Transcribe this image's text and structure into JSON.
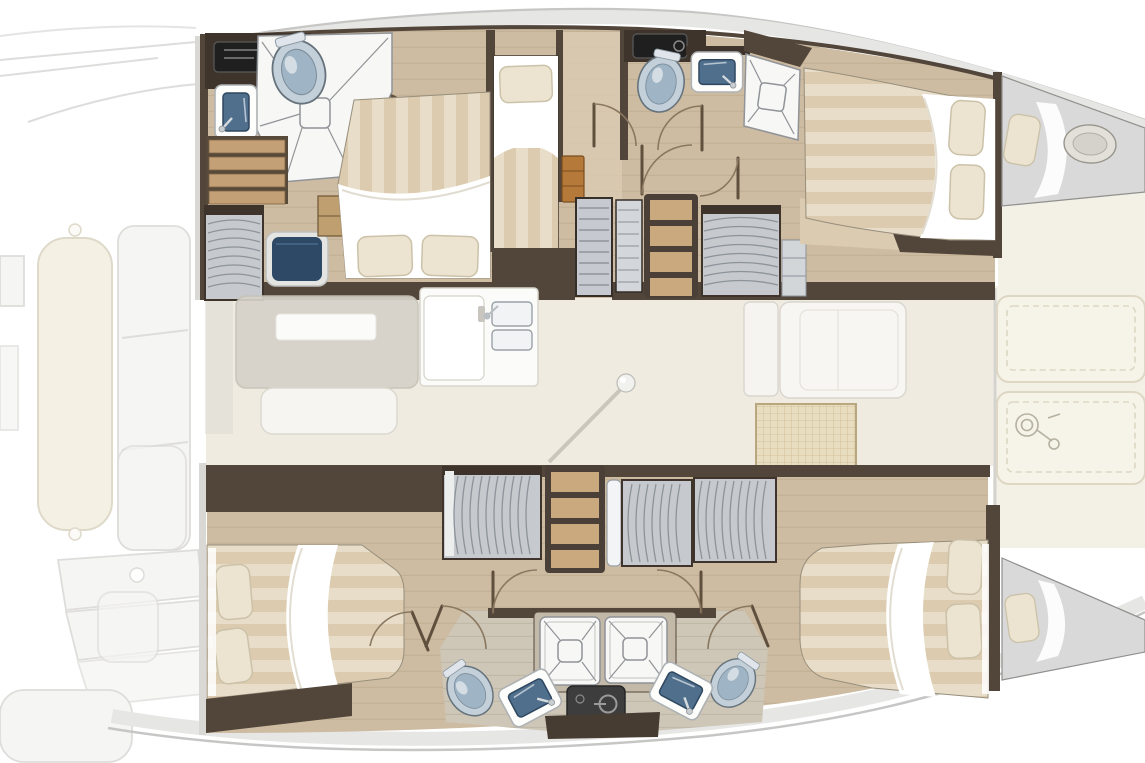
{
  "meta": {
    "type": "yacht-floorplan",
    "vessel": "catamaran",
    "view": "overhead interior deck plan, bows pointing right, no text labels in image"
  },
  "plan": {
    "hulls": [
      {
        "name": "upper hull",
        "rooms": [
          "aft bathroom with shower, toilet and washbasin",
          "aft double cabin with desk chair and wardrobe",
          "midship single berth",
          "midship bathroom with shower, toilet and washbasin",
          "forward double cabin",
          "forepeak crew berth"
        ]
      },
      {
        "name": "lower hull",
        "rooms": [
          "aft double cabin",
          "wardrobe and shelving corridor",
          "twin back-to-back bathrooms with two showers, two toilets, two washbasins and engine hatch",
          "forward double cabin",
          "forepeak crew berth"
        ]
      }
    ],
    "bridgedeck": [
      "faded salon table and bench",
      "galley counter with double sink",
      "mast step ball with shadow line",
      "galley island units",
      "woven floor mat",
      "foredeck lounge cushions",
      "windlass outline"
    ],
    "exterior_faded": [
      "side deck lines",
      "long seat cushion",
      "segmented seat back",
      "stern steps",
      "aft bench",
      "sun pads"
    ],
    "fixture_counts": {
      "double_beds": 4,
      "single_berths": 3,
      "toilets": 4,
      "washbasins": 6,
      "showers": 4,
      "wardrobes": 5,
      "shelf_units": 2,
      "stair_flights": 2,
      "door_swings": 11
    }
  },
  "icons": [
    "toilet-icon",
    "washbasin-icon",
    "shower-grate-icon",
    "clothes-rail-icon",
    "mast-ball-icon",
    "windlass-icon",
    "engine-start-icon",
    "door-swing-icon"
  ],
  "colors": {
    "paper": "#ffffff",
    "wall_dark": "#52463b",
    "wall_darker": "#3e342b",
    "wood_floor": "#cdbca2",
    "wood_line": "#b9a789",
    "wood_light": "#dacbb1",
    "corridor": "#d8c9b0",
    "bath_floor": "#cec6b6",
    "salon_floor": "#efebe1",
    "cream_deck": "#f3f0e6",
    "bench_cream": "#f6f3e9",
    "bench_line": "#ddd7c4",
    "deck_silver": "#e6e6e5",
    "deck_silver_line": "#c6c6c5",
    "fixture_white": "#f7f7f5",
    "fixture_line": "#909398",
    "basin_blue": "#4f6f8d",
    "basin_deep": "#2e475e",
    "toilet_fill": "#c3d0da",
    "toilet_inner": "#9fb4c4",
    "toilet_line": "#66727c",
    "mattress": "#e7ddc8",
    "mattress_stripe": "#dbccae",
    "duvet": "#ffffff",
    "pillow": "#ece4d1",
    "pillow_line": "#ccc2a9",
    "wardrobe_gray": "#c6cace",
    "wardrobe_line": "#8d939b",
    "shelf_wood": "#c9a97d",
    "step_wood": "#c3a076",
    "step_line": "#7d6344",
    "cabinet_orange": "#b5793a",
    "chair_navy": "#2d4966",
    "chair_frame": "#e4e4e2",
    "engine_dark": "#3d3d3d",
    "engine_line": "#9a9a9a",
    "mat_fill": "#e9ddbf",
    "mat_line": "#cbb890",
    "mat_border": "#b9a87f",
    "door_line": "#8a7760",
    "door_leaf": "#5f4f3d",
    "faded_line": "#dedddb",
    "faded_fill": "#f5f5f3",
    "faded_cream": "#f4f0e4",
    "faded_cream_line": "#ded9c9",
    "table_gray": "#d6d2c9",
    "table_line": "#c5c1b7",
    "mast_line": "#c5c0b6",
    "berth_gray": "#d8d9d8",
    "berth_line": "#8f8f8c"
  },
  "labels": {
    "canvas": "Catamaran interior layout plan",
    "hull_top": "Upper hull: aft bathroom, aft double cabin, single berth, midship bathroom, forward double cabin, forepeak berth",
    "hull_bottom": "Lower hull: aft double cabin, wardrobes, twin bathrooms, forward double cabin, forepeak berth",
    "salon": "Bridgedeck salon with faded table, galley sink, island units and mast step",
    "foredeck": "Foredeck lounge with two cushioned sun pads and windlass",
    "exterior": "Faded exterior decks, seats and stern steps"
  }
}
